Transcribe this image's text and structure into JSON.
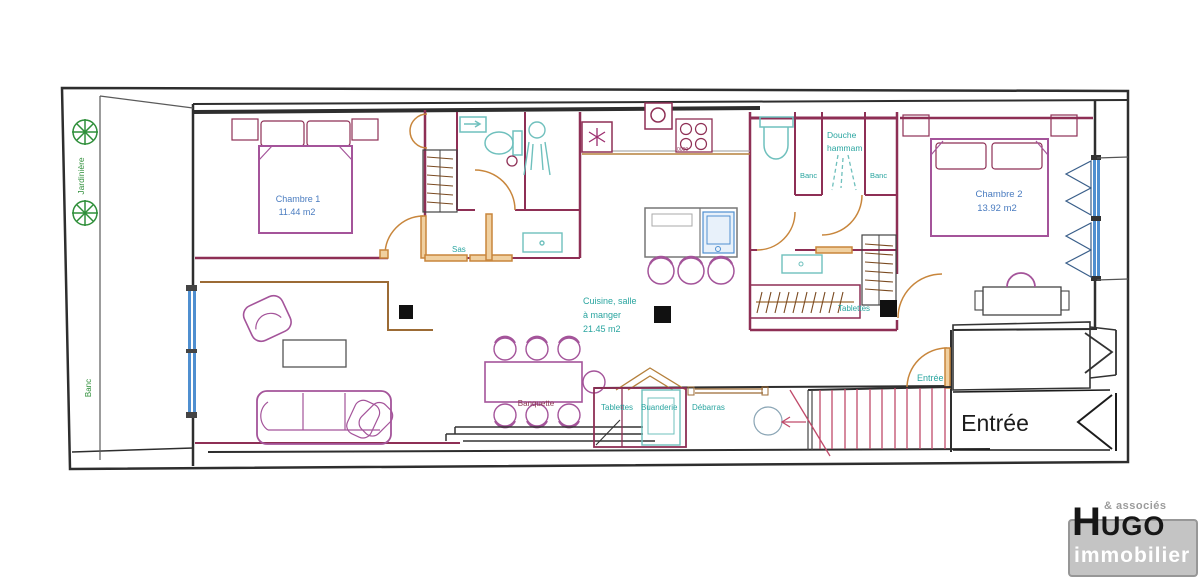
{
  "palette": {
    "wall_black": "#2e2e2e",
    "wall_crimson": "#8e2f55",
    "door_orange": "#c8863c",
    "furniture_magenta": "#a4549a",
    "fixture_teal": "#6fc0bd",
    "window_blue": "#4f8fd0",
    "stairs_red": "#c04a6a",
    "label_teal": "#2aa5a0",
    "label_blue": "#4a7cc0",
    "label_green": "#2f8f3a",
    "label_dark": "#1c1c1c",
    "banquette_maroon": "#8b3550"
  },
  "plan": {
    "terrace": {
      "jardiniere": "Jardinière",
      "banc": "Banc"
    },
    "rooms": {
      "chambre1": {
        "name": "Chambre 1",
        "area": "11.44 m2"
      },
      "sas": {
        "name": "Sas"
      },
      "cuisine": {
        "name_line1": "Cuisine, salle",
        "name_line2": "à manger",
        "area": "21.45 m2"
      },
      "douche": {
        "name_line1": "Douche",
        "name_line2": "hammam"
      },
      "banc_left": {
        "name": "Banc"
      },
      "banc_right": {
        "name": "Banc"
      },
      "chambre2": {
        "name": "Chambre 2",
        "area": "13.92 m2"
      },
      "dressing": {
        "tablettes": "Tablettes"
      },
      "buanderie": {
        "name": "Buanderie",
        "tablettes": "Tablettes"
      },
      "debarras": {
        "name": "Débarras"
      },
      "banquette": {
        "name": "Banquette"
      },
      "entree_door": {
        "name": "Entrée"
      },
      "entree_hall": {
        "name": "Entrée"
      }
    },
    "markings": {
      "stove": "0000"
    }
  },
  "logo": {
    "tagline": "& associés",
    "name_initial": "H",
    "name_rest": "UGO",
    "subtitle": "immobilier"
  }
}
